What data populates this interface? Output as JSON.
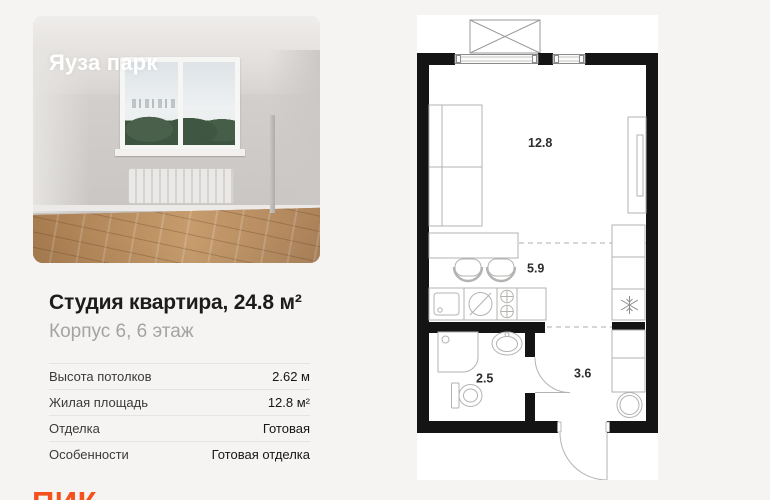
{
  "project": {
    "name": "Яуза парк"
  },
  "listing": {
    "title": "Студия квартира, 24.8 м²",
    "subtitle": "Корпус 6, 6 этаж"
  },
  "details": [
    {
      "label": "Высота потолков",
      "value": "2.62 м"
    },
    {
      "label": "Жилая площадь",
      "value": "12.8 м²"
    },
    {
      "label": "Отделка",
      "value": "Готовая"
    },
    {
      "label": "Особенности",
      "value": "Готовая отделка"
    }
  ],
  "brand": {
    "logo_text": "ПИК",
    "logo_color": "#F4511E"
  },
  "page": {
    "background": "#f5f4f2"
  },
  "floorplan": {
    "areas": {
      "living": "12.8",
      "kitchen": "5.9",
      "bathroom": "2.5",
      "hallway": "3.6"
    },
    "colors": {
      "wall": "#141414",
      "furniture_line": "#b3b3b1",
      "background": "#ffffff"
    }
  }
}
